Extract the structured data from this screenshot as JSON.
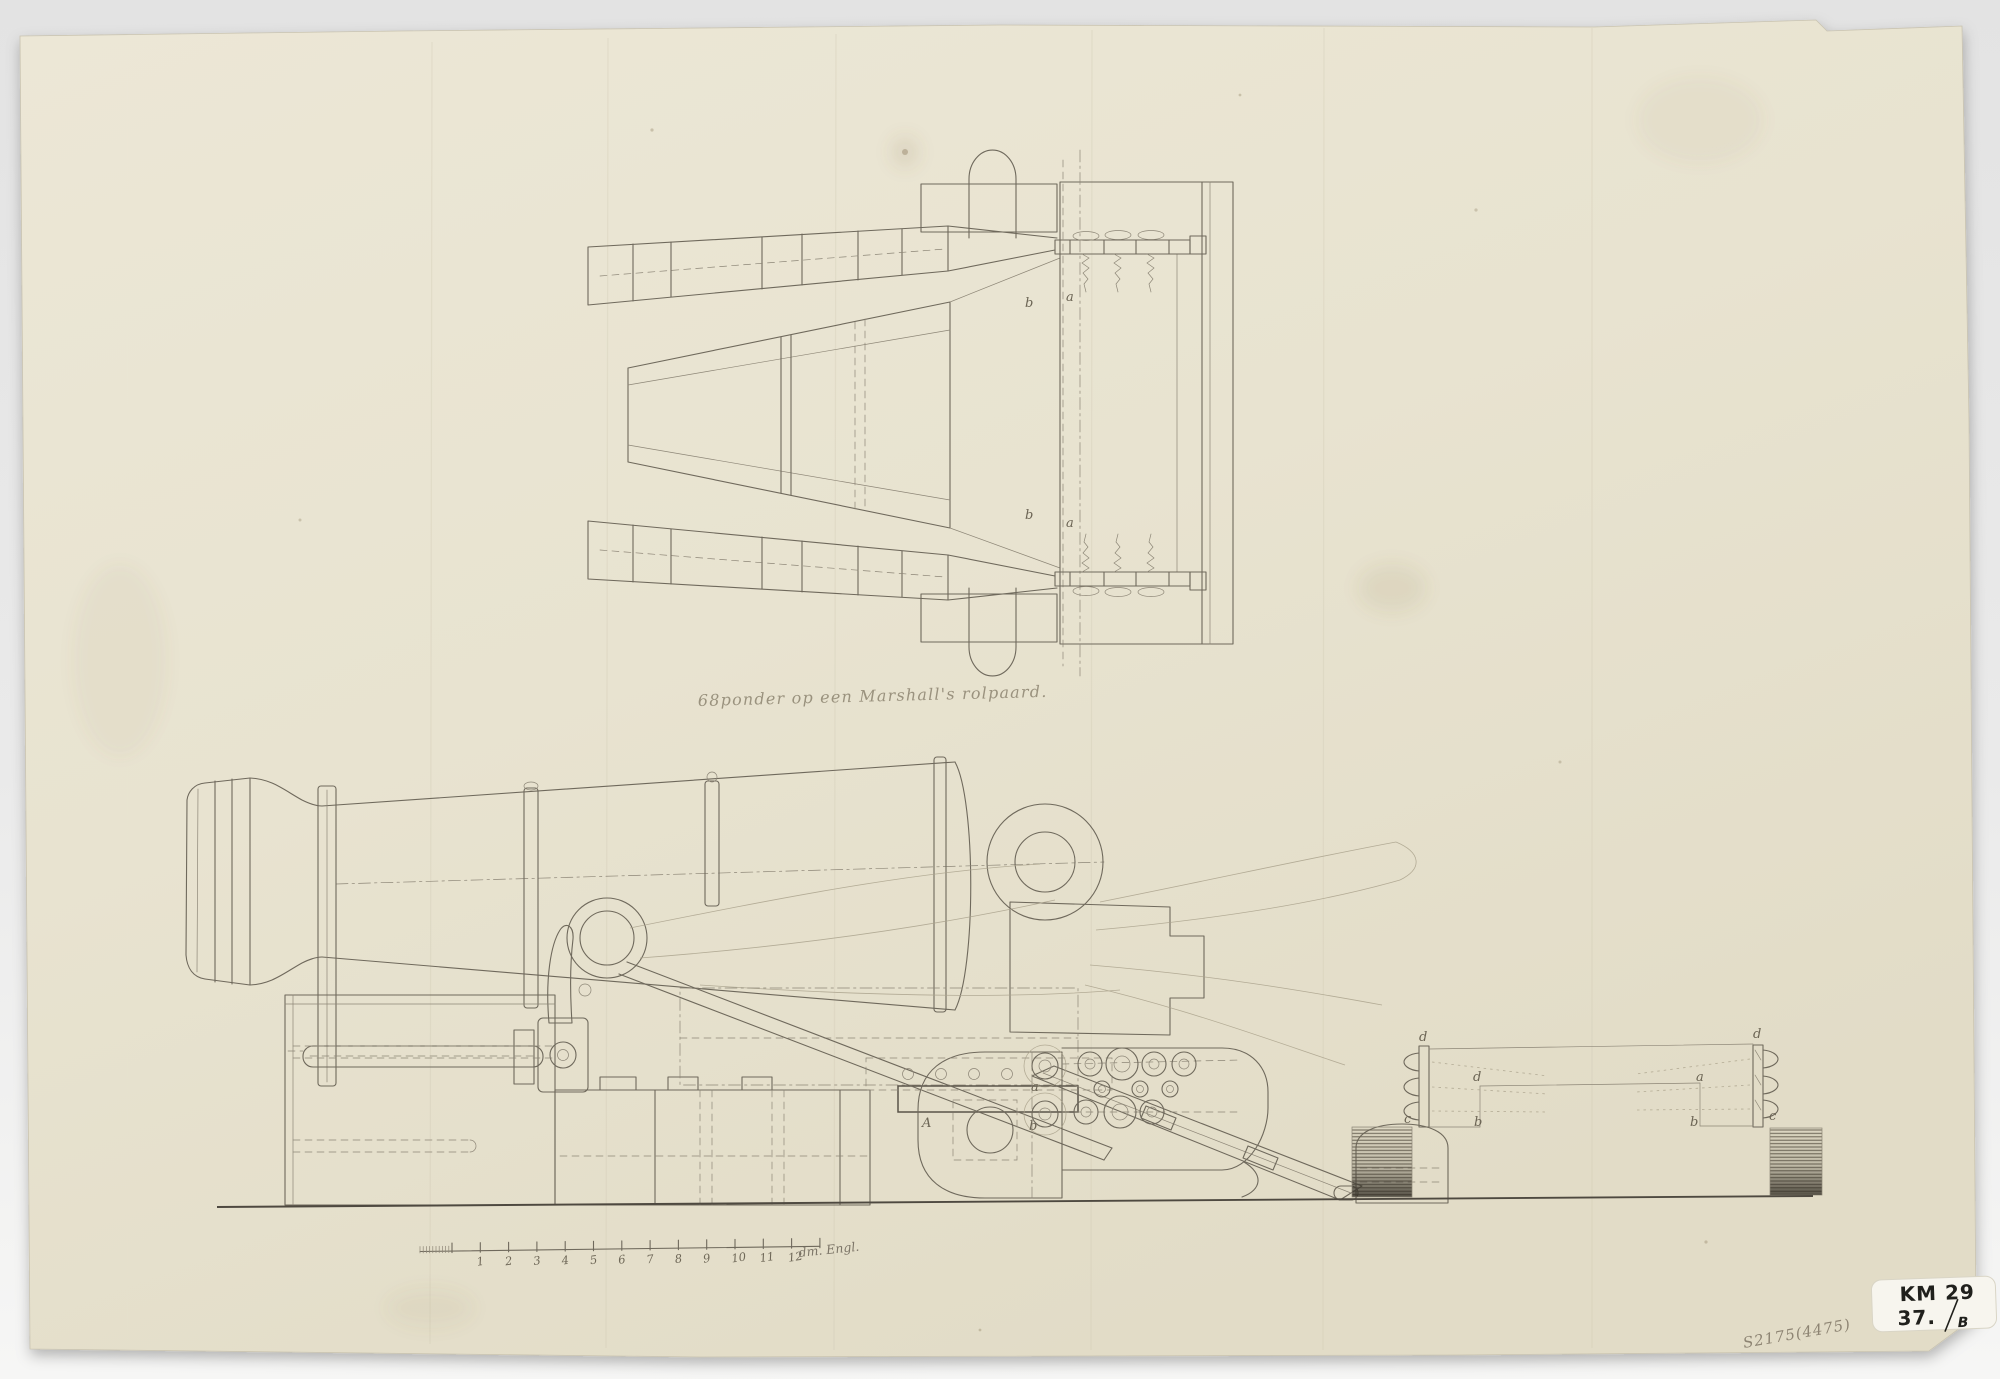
{
  "caption": "68ponder op een Marshall's rolpaard.",
  "scale_bar": {
    "numbers": [
      "1",
      "2",
      "3",
      "4",
      "5",
      "6",
      "7",
      "8",
      "9",
      "10",
      "11",
      "12"
    ],
    "unit_label": "dm. Engl."
  },
  "marks": {
    "sticker_line1": "KM 29",
    "sticker_line2": "37.",
    "sticker_suffix": "B",
    "pencil_inventory": "S2175(4475)"
  },
  "annotations": [
    {
      "t": "a",
      "x": 1066,
      "y": 301
    },
    {
      "t": "b",
      "x": 1025,
      "y": 307
    },
    {
      "t": "b",
      "x": 1025,
      "y": 519
    },
    {
      "t": "a",
      "x": 1066,
      "y": 527
    },
    {
      "t": "A",
      "x": 922,
      "y": 1127
    },
    {
      "t": "a",
      "x": 1031,
      "y": 1091
    },
    {
      "t": "b",
      "x": 1029,
      "y": 1130
    },
    {
      "t": "d",
      "x": 1419,
      "y": 1041
    },
    {
      "t": "c",
      "x": 1404,
      "y": 1123
    },
    {
      "t": "d",
      "x": 1473,
      "y": 1081
    },
    {
      "t": "b",
      "x": 1474,
      "y": 1126
    },
    {
      "t": "a",
      "x": 1696,
      "y": 1081
    },
    {
      "t": "b",
      "x": 1690,
      "y": 1126
    },
    {
      "t": "c",
      "x": 1769,
      "y": 1120
    },
    {
      "t": "d",
      "x": 1753,
      "y": 1038
    }
  ],
  "colors": {
    "background": "#e8e8e8",
    "paper": "#e9e4d2",
    "ink": "#6f695c",
    "ink_dark": "#4e4940",
    "pencil": "#8d8473",
    "sticker": "#f7f5ee"
  }
}
